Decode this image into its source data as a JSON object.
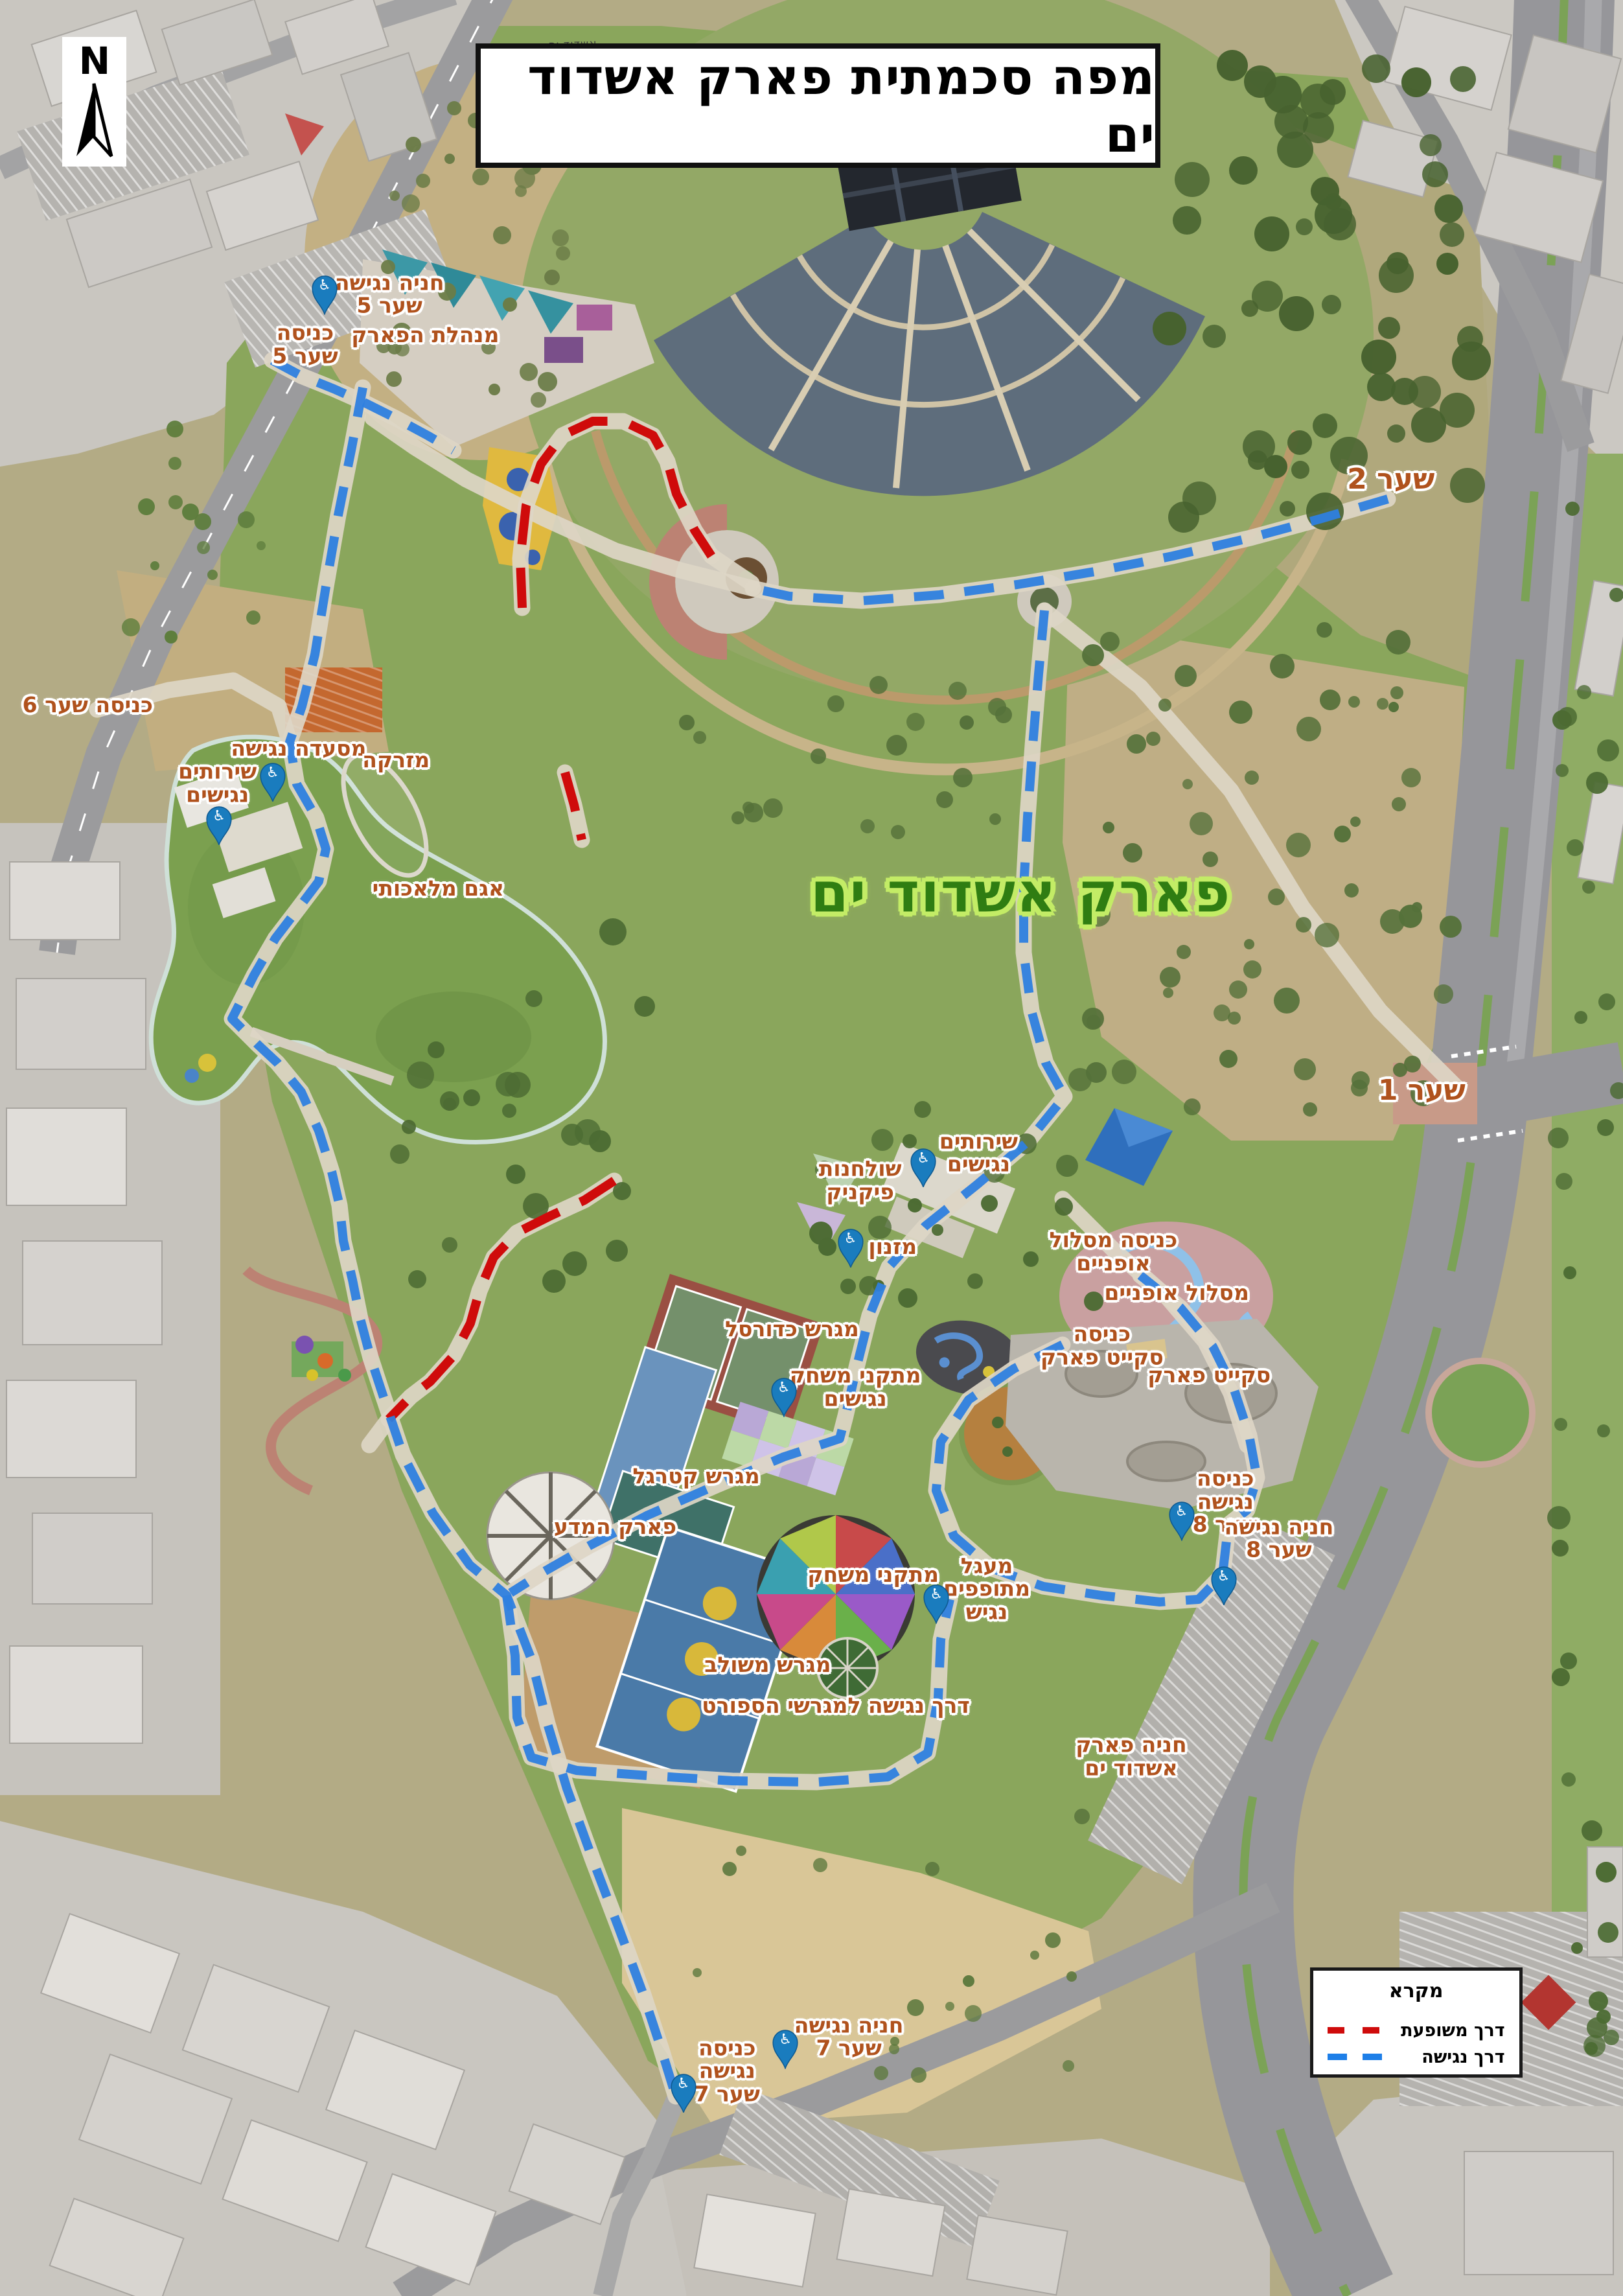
{
  "title": {
    "text": "מפה סכמתית פארק אשדוד ים"
  },
  "north": {
    "letter": "N"
  },
  "street_label": {
    "text": "אשדוד ים"
  },
  "legend": {
    "title": "מקרא",
    "items": [
      {
        "label": "דרך משופעת",
        "color": "#cf0b0b"
      },
      {
        "label": "דרך נגישה",
        "color": "#1e7fe8"
      }
    ]
  },
  "colors": {
    "label_orange": "#b0521d",
    "park_green": "#2f7d12",
    "park_halo": "#c3ec66",
    "route_accessible": "#2e7fdf",
    "route_sloped": "#cf0b0b",
    "pin_blue": "#1a7cbe"
  },
  "labels": [
    {
      "text": "חניה נגישה\nשער 5",
      "x": 24.0,
      "y": 12.8,
      "kind": "default"
    },
    {
      "text": "כניסה\nשער 5",
      "x": 18.8,
      "y": 15.0,
      "kind": "default"
    },
    {
      "text": "מנהלת הפארק",
      "x": 26.2,
      "y": 14.6,
      "kind": "default"
    },
    {
      "text": "כניסה שער 6",
      "x": 5.4,
      "y": 30.7,
      "kind": "default"
    },
    {
      "text": "מסעדה נגישה",
      "x": 18.4,
      "y": 32.6,
      "kind": "default"
    },
    {
      "text": "שירותים\nנגישים",
      "x": 13.4,
      "y": 34.1,
      "kind": "default"
    },
    {
      "text": "מזרקה",
      "x": 24.4,
      "y": 33.1,
      "kind": "default"
    },
    {
      "text": "אגם מלאכותי",
      "x": 27.0,
      "y": 38.7,
      "kind": "default"
    },
    {
      "text": "שער 2",
      "x": 85.7,
      "y": 20.9,
      "kind": "gate"
    },
    {
      "text": "שער 1",
      "x": 87.6,
      "y": 47.5,
      "kind": "gate"
    },
    {
      "text": "פארק אשדוד ים",
      "x": 62.9,
      "y": 38.9,
      "kind": "park"
    },
    {
      "text": "שירותים\nנגישים",
      "x": 60.3,
      "y": 50.2,
      "kind": "default"
    },
    {
      "text": "שולחנות\nפיקניק",
      "x": 53.0,
      "y": 51.4,
      "kind": "default"
    },
    {
      "text": "מזנון",
      "x": 55.0,
      "y": 54.3,
      "kind": "default"
    },
    {
      "text": "כניסה מסלול\nאופניים",
      "x": 68.6,
      "y": 54.5,
      "kind": "default"
    },
    {
      "text": "מסלול אופניים",
      "x": 72.5,
      "y": 56.3,
      "kind": "default"
    },
    {
      "text": "מגרש כדורסל",
      "x": 48.8,
      "y": 57.9,
      "kind": "default"
    },
    {
      "text": "מתקני משחק\nנגישים",
      "x": 52.7,
      "y": 60.4,
      "kind": "default"
    },
    {
      "text": "מגרש קטרגל",
      "x": 42.9,
      "y": 64.3,
      "kind": "default"
    },
    {
      "text": "פארק המדע",
      "x": 37.9,
      "y": 66.5,
      "kind": "default"
    },
    {
      "text": "מתקני משחק",
      "x": 53.8,
      "y": 68.6,
      "kind": "default"
    },
    {
      "text": "מגרש משולב",
      "x": 47.3,
      "y": 72.5,
      "kind": "default"
    },
    {
      "text": "דרך נגישה למגרשי הספורט",
      "x": 51.5,
      "y": 74.3,
      "kind": "default"
    },
    {
      "text": "כניסה\nסקייט פארק",
      "x": 67.9,
      "y": 58.6,
      "kind": "default"
    },
    {
      "text": "סקייט פארק",
      "x": 74.5,
      "y": 59.9,
      "kind": "default"
    },
    {
      "text": "כניסה\nנגישה\nשער 8",
      "x": 75.5,
      "y": 65.4,
      "kind": "default"
    },
    {
      "text": "חניה נגישה\nשער 8",
      "x": 78.8,
      "y": 67.0,
      "kind": "default"
    },
    {
      "text": "מעגל\nמתופפים\nנגיש",
      "x": 60.8,
      "y": 69.2,
      "kind": "default"
    },
    {
      "text": "חניה פארק\nאשדוד ים",
      "x": 69.7,
      "y": 76.5,
      "kind": "default"
    },
    {
      "text": "חניה נגישה\nשער 7",
      "x": 52.3,
      "y": 88.7,
      "kind": "default"
    },
    {
      "text": "כניסה\nנגישה\nשער 7",
      "x": 44.8,
      "y": 90.2,
      "kind": "default"
    }
  ],
  "pins": [
    {
      "name": "accessible-parking-gate5",
      "x": 20.0,
      "y": 13.7
    },
    {
      "name": "accessible-restaurant",
      "x": 16.8,
      "y": 34.9
    },
    {
      "name": "accessible-toilets-west",
      "x": 13.5,
      "y": 36.8
    },
    {
      "name": "accessible-toilets-center",
      "x": 56.9,
      "y": 51.7
    },
    {
      "name": "accessible-kiosk",
      "x": 52.4,
      "y": 55.2
    },
    {
      "name": "accessible-playground",
      "x": 48.3,
      "y": 61.7
    },
    {
      "name": "accessible-drum-circle",
      "x": 57.7,
      "y": 70.7
    },
    {
      "name": "accessible-entrance-gate8",
      "x": 72.8,
      "y": 67.1
    },
    {
      "name": "accessible-parking-gate8",
      "x": 75.4,
      "y": 69.9
    },
    {
      "name": "accessible-parking-gate7",
      "x": 48.4,
      "y": 90.1
    },
    {
      "name": "accessible-entrance-gate7",
      "x": 42.1,
      "y": 92.0
    }
  ]
}
